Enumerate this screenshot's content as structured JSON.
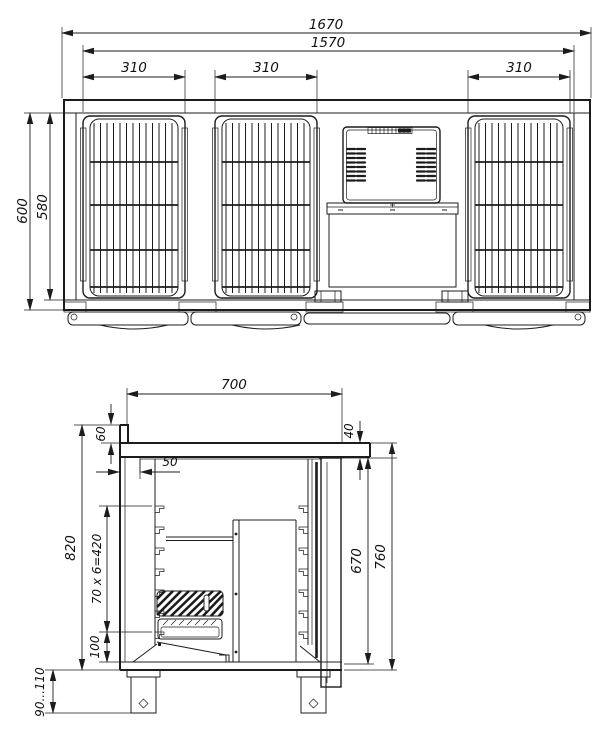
{
  "drawing": {
    "kind": "technical dimension drawing",
    "subject": "refrigerated counter with wire grille doors",
    "line_color": "#1c1c1c",
    "background": "#ffffff"
  },
  "front": {
    "dims": {
      "overall_width": "1670",
      "body_width": "1570",
      "door_left": "310",
      "door_middle": "310",
      "door_right": "310",
      "overall_height": "600",
      "door_height": "580"
    }
  },
  "side": {
    "dims": {
      "depth": "700",
      "backsplash_height": "60",
      "worktop_thickness": "40",
      "back_wall_offset": "50",
      "body_height": "820",
      "shelf_rail_pitch": "70 x 6=420",
      "bottom_offset": "100",
      "door_height": "670",
      "front_height": "760",
      "leg_height": "90...110"
    }
  }
}
